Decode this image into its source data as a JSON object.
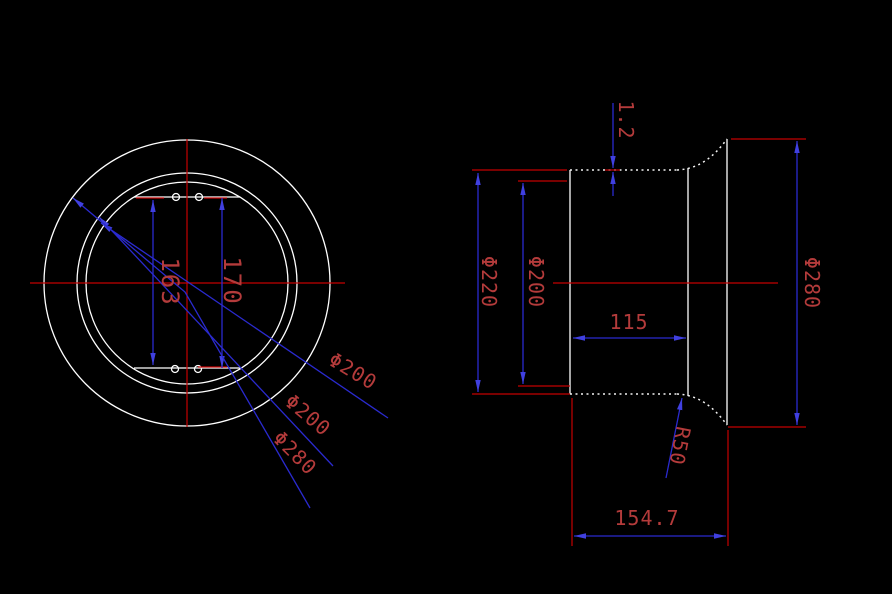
{
  "canvas": {
    "background": "#000000",
    "description_colors": {
      "part_outline_white": "#ffffff",
      "dimension_extension_red": "#c40000",
      "dimension_line_blue": "#2a2ace",
      "dimension_text_red": "#b43b3b"
    }
  },
  "left_view": {
    "dim_163": "163",
    "dim_170": "170",
    "leader_phi200_a": "Φ200",
    "leader_phi200_b": "Φ200",
    "leader_phi280": "Φ280"
  },
  "right_view": {
    "dim_wall": "1.2",
    "dim_phi220": "Φ220",
    "dim_phi200": "Φ200",
    "dim_115": "115",
    "dim_phi280": "Φ280",
    "dim_r50": "R50",
    "dim_total": "154.7"
  }
}
